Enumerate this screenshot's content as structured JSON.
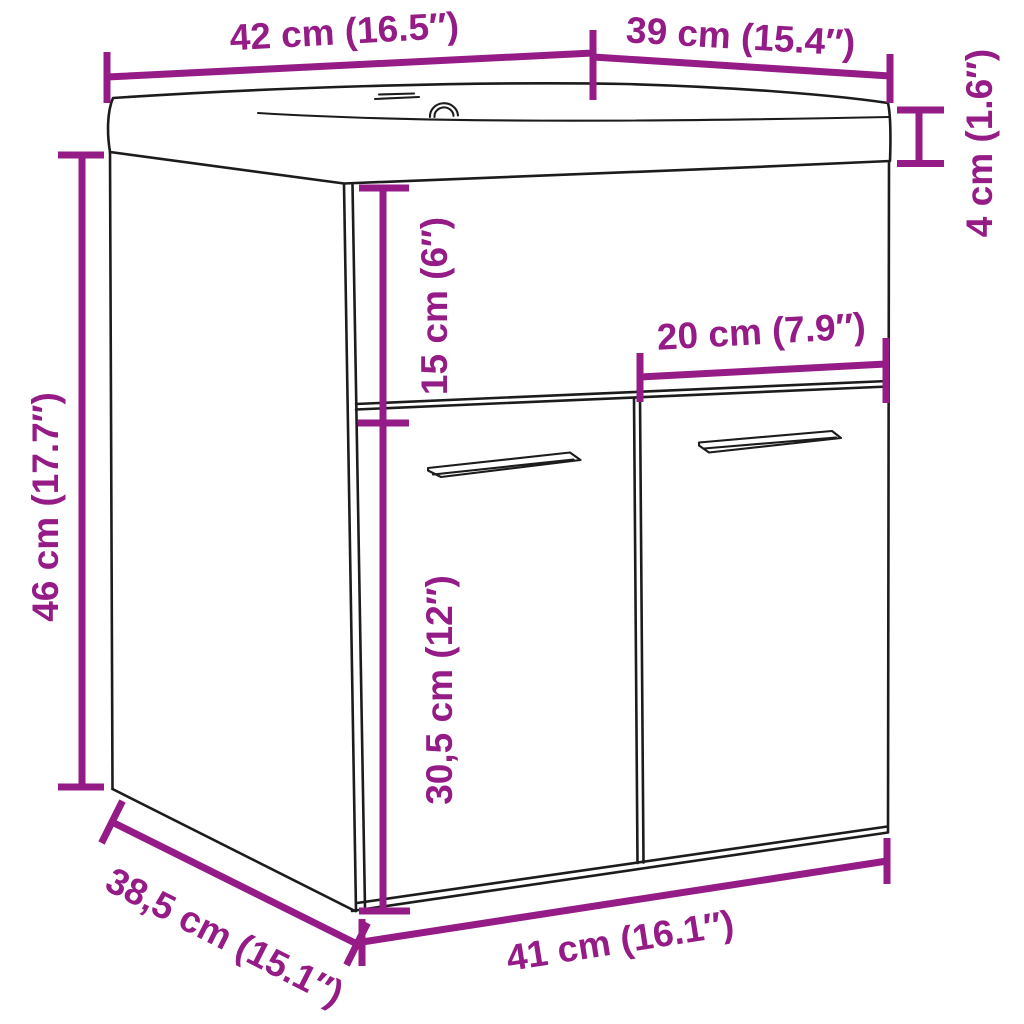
{
  "diagram": {
    "type": "product-dimension-diagram",
    "product": "bathroom sink cabinet with two doors and integrated basin",
    "background_color": "#ffffff",
    "line_color": "#1c1c1c",
    "accent_color": "#951B87",
    "dimensions": {
      "top_width": "42 cm (16.5″)",
      "top_depth": "39 cm (15.4″)",
      "basin_height": "4 cm (1.6″)",
      "upper_section_height": "15 cm (6″)",
      "right_door_width": "20 cm (7.9″)",
      "cabinet_height": "46 cm (17.7″)",
      "door_height": "30,5 cm (12″)",
      "base_depth": "38,5 cm (15.1″)",
      "base_width": "41 cm (16.1″)"
    }
  }
}
